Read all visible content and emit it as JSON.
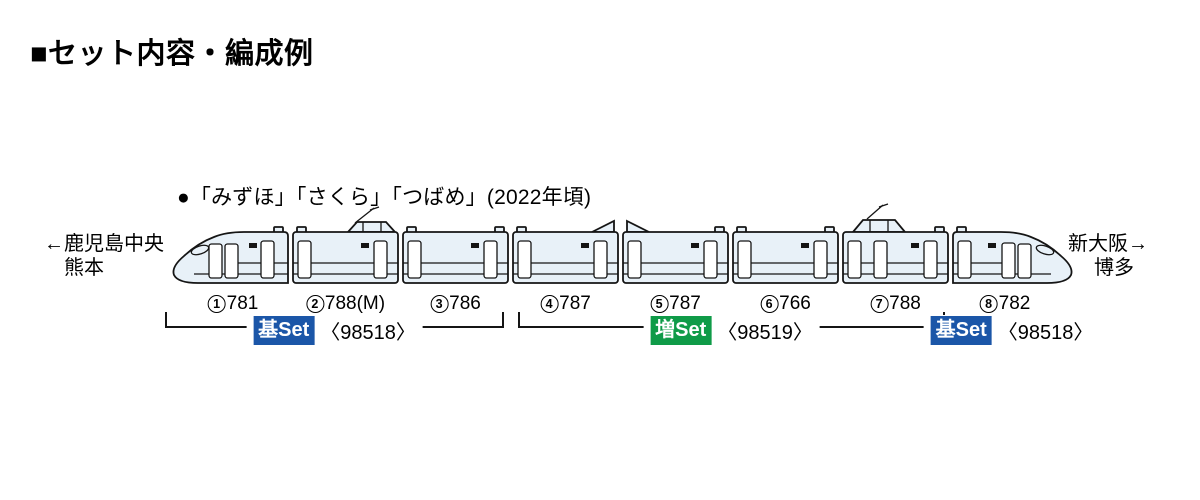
{
  "title": "■セット内容・編成例",
  "note": "●「みずほ」「さくら」「つばめ」(2022年頃)",
  "destination_left": {
    "line1": "←鹿児島中央",
    "line2": "熊本"
  },
  "destination_right": {
    "line1": "新大阪→",
    "line2": "博多"
  },
  "cars": [
    {
      "num": "1",
      "series": "781",
      "suffix": "",
      "type": "cab-left"
    },
    {
      "num": "2",
      "series": "788",
      "suffix": "(M)",
      "type": "middle-pantograph"
    },
    {
      "num": "3",
      "series": "786",
      "suffix": "",
      "type": "middle"
    },
    {
      "num": "4",
      "series": "787",
      "suffix": "",
      "type": "middle-fairing-right"
    },
    {
      "num": "5",
      "series": "787",
      "suffix": "",
      "type": "middle-fairing-left"
    },
    {
      "num": "6",
      "series": "766",
      "suffix": "",
      "type": "middle"
    },
    {
      "num": "7",
      "series": "788",
      "suffix": "",
      "type": "middle-pantograph-3door"
    },
    {
      "num": "8",
      "series": "782",
      "suffix": "",
      "type": "cab-right"
    }
  ],
  "sets": [
    {
      "badge": "基Set",
      "code": "〈98518〉",
      "color": "#1b56a8",
      "first_car": 1,
      "last_car": 3,
      "bracket": true
    },
    {
      "badge": "増Set",
      "code": "〈98519〉",
      "color": "#0f9b48",
      "first_car": 4,
      "last_car": 7,
      "bracket": true
    },
    {
      "badge": "基Set",
      "code": "〈98518〉",
      "color": "#1b56a8",
      "first_car": 8,
      "last_car": 8,
      "bracket": false
    }
  ],
  "colors": {
    "body_fill": "#e8f1f8",
    "outline": "#151515",
    "badge_text": "#ffffff",
    "text": "#000000"
  }
}
